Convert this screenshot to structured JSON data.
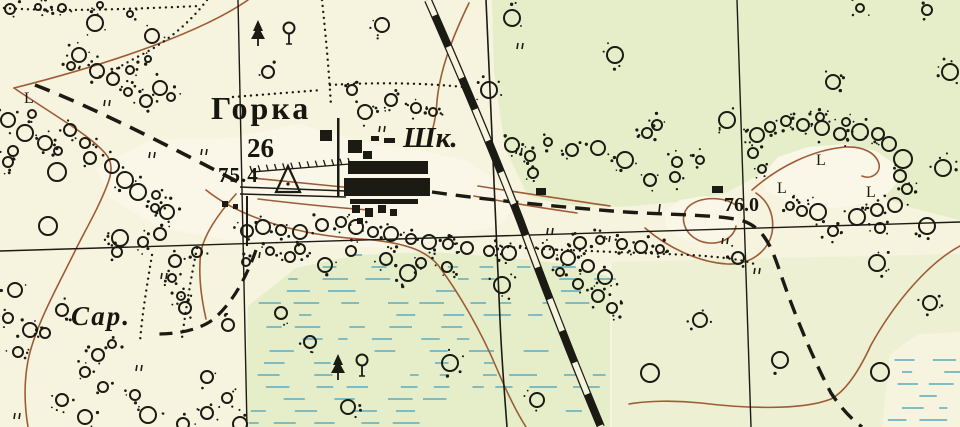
{
  "title": "Topographic map fragment — village Gorka",
  "labels": {
    "settlement": {
      "text": "Горка",
      "meaning": "village name"
    },
    "household_count": {
      "text": "26",
      "meaning": "number of households"
    },
    "elevation_point": {
      "text": "75.4",
      "meaning": "triangulation point elevation"
    },
    "school": {
      "text": "Шк.",
      "meaning": "school abbreviation"
    },
    "spot_height": {
      "text": "76.0",
      "meaning": "spot height"
    },
    "barn": {
      "text": "Сар.",
      "meaning": "barn abbreviation"
    },
    "meadow_letter": "L"
  },
  "colors": {
    "paper": "#f6f3de",
    "green_wash": "#e4edc6",
    "clearing_cream": "#faf7e8",
    "ink": "#1b1b13",
    "contour_brown": "#9e5c36",
    "marsh_blue": "#6fb4c2"
  },
  "map": {
    "width": 960,
    "height": 427,
    "grid_lines": [
      [
        238,
        0,
        247,
        427
      ],
      [
        737,
        0,
        751,
        427
      ],
      [
        0,
        251,
        960,
        222
      ]
    ],
    "railroad": {
      "d": "M428,0 C458,68 492,148 520,220 C545,288 575,365 601,427",
      "width": 8,
      "tie_dash": "34 34"
    },
    "boundary_line": {
      "d": "M486,0 C491,110 496,230 500,320 C502,365 505,400 507,427",
      "width": 1.6
    },
    "roads": [
      {
        "d": "M35,85 C100,110 180,152 242,184",
        "width": 3.6,
        "dash": "16 10"
      },
      {
        "d": "M432,192 C480,199 550,206 612,211 C660,215 712,214 740,220 C763,226 771,246 779,269 C793,311 813,359 831,393 C843,411 853,420 862,427",
        "width": 3.4,
        "dash": "15 9"
      },
      {
        "d": "M256,250 C246,278 234,300 216,317 C203,329 180,334 158,334",
        "width": 3.2,
        "dash": "13 8"
      },
      {
        "d": "M240,187 L346,191",
        "width": 1.5,
        "dash": ""
      },
      {
        "d": "M240,194 L346,197",
        "width": 1.5,
        "dash": ""
      }
    ],
    "contours": [
      "M248,0 C205,30 118,62 14,88",
      "M14,88 C55,116 88,134 105,153 C113,162 112,172 108,183 C99,207 87,227 76,249 C60,282 38,320 29,356 C23,383 25,409 28,427",
      "M236,194 C218,214 205,233 201,251 C198,273 201,297 206,319",
      "M469,3 C452,38 440,70 437,101 C436,119 433,131 428,141",
      "M206,190 C242,219 300,235 360,239 C406,242 426,251 438,265 C459,293 481,331 497,369 C508,395 517,413 526,427",
      "M252,178 C300,183 330,186 353,188",
      "M258,199 C300,204 340,208 369,210",
      "M478,186 C528,194 570,200 610,206",
      "M474,196 C515,204 549,209 577,213",
      "M737,206 C724,196 700,196 688,207 C679,218 684,234 700,241 C717,247 734,239 736,226",
      "M645,228 C667,247 697,262 727,264 C751,265 768,251 772,233 C775,215 768,201 756,193",
      "M752,190 C778,167 812,150 845,147 C863,146 876,153 879,164 C881,173 871,180 862,176",
      "M960,246 C930,262 896,300 871,345 C859,371 846,391 831,399 C801,411 741,408 701,403 C673,400 646,401 629,404"
    ],
    "green_washes": [
      {
        "poly": [
          [
            492,
            0
          ],
          [
            960,
            0
          ],
          [
            960,
            220
          ],
          [
            912,
            208
          ],
          [
            878,
            196
          ],
          [
            852,
            162
          ],
          [
            812,
            148
          ],
          [
            768,
            170
          ],
          [
            724,
            194
          ],
          [
            678,
            202
          ],
          [
            620,
            207
          ],
          [
            560,
            204
          ],
          [
            528,
            196
          ],
          [
            505,
            148
          ],
          [
            494,
            70
          ]
        ],
        "opacity": 0.9
      },
      {
        "poly": [
          [
            246,
            427
          ],
          [
            248,
            306
          ],
          [
            296,
            268
          ],
          [
            358,
            255
          ],
          [
            430,
            252
          ],
          [
            500,
            257
          ],
          [
            566,
            264
          ],
          [
            610,
            277
          ],
          [
            610,
            427
          ]
        ],
        "opacity": 0.9
      },
      {
        "poly": [
          [
            612,
            262
          ],
          [
            960,
            254
          ],
          [
            960,
            332
          ],
          [
            918,
            334
          ],
          [
            890,
            354
          ],
          [
            882,
            427
          ],
          [
            612,
            427
          ]
        ],
        "opacity": 0.45
      }
    ],
    "clearings": [
      [
        [
          760,
          178
        ],
        [
          778,
          157
        ],
        [
          808,
          147
        ],
        [
          845,
          144
        ],
        [
          876,
          151
        ],
        [
          894,
          164
        ],
        [
          898,
          182
        ],
        [
          884,
          197
        ],
        [
          854,
          206
        ],
        [
          820,
          209
        ],
        [
          789,
          201
        ],
        [
          767,
          192
        ]
      ],
      [
        [
          664,
          212
        ],
        [
          680,
          200
        ],
        [
          704,
          196
        ],
        [
          726,
          200
        ],
        [
          738,
          212
        ],
        [
          736,
          228
        ],
        [
          720,
          240
        ],
        [
          698,
          243
        ],
        [
          678,
          238
        ],
        [
          666,
          228
        ]
      ],
      [
        [
          96,
          168
        ],
        [
          150,
          140
        ],
        [
          230,
          138
        ],
        [
          300,
          124
        ],
        [
          360,
          142
        ],
        [
          430,
          152
        ],
        [
          470,
          162
        ],
        [
          500,
          185
        ],
        [
          520,
          200
        ],
        [
          500,
          225
        ],
        [
          450,
          238
        ],
        [
          380,
          248
        ],
        [
          300,
          243
        ],
        [
          230,
          240
        ],
        [
          160,
          228
        ],
        [
          110,
          198
        ]
      ]
    ],
    "marsh_regions": [
      {
        "poly": [
          [
            250,
            302
          ],
          [
            298,
            264
          ],
          [
            360,
            252
          ],
          [
            430,
            249
          ],
          [
            500,
            254
          ],
          [
            565,
            262
          ],
          [
            612,
            276
          ],
          [
            612,
            427
          ],
          [
            248,
            427
          ]
        ],
        "step": 12
      },
      {
        "poly": [
          [
            893,
            352
          ],
          [
            960,
            342
          ],
          [
            960,
            427
          ],
          [
            880,
            427
          ]
        ],
        "step": 12
      }
    ],
    "dotted_trails": [
      "M4,8 C60,12 130,9 200,6",
      "M207,0 C192,20 170,40 143,54 C130,61 120,66 112,72",
      "M233,97 L322,90",
      "M330,85 C380,82 430,83 472,88",
      "M322,0 C326,38 329,72 331,106",
      "M490,246 C550,250 620,252 690,255 C722,257 745,260 754,264",
      "M197,248 C191,278 186,308 182,338",
      "M152,255 C147,285 142,315 140,342"
    ],
    "buildings": [
      [
        337,
        118,
        2.5,
        78
      ],
      [
        348,
        161,
        80,
        13
      ],
      [
        344,
        178,
        86,
        18
      ],
      [
        350,
        199,
        68,
        5
      ],
      [
        320,
        130,
        12,
        11
      ],
      [
        348,
        140,
        14,
        13
      ],
      [
        363,
        151,
        9,
        8
      ],
      [
        371,
        136,
        8,
        5
      ],
      [
        384,
        138,
        11,
        5
      ],
      [
        352,
        205,
        8,
        8
      ],
      [
        365,
        208,
        8,
        9
      ],
      [
        378,
        205,
        8,
        8
      ],
      [
        390,
        209,
        7,
        7
      ],
      [
        357,
        218,
        6,
        6
      ],
      [
        222,
        201,
        6,
        6
      ],
      [
        233,
        204,
        5,
        5
      ],
      [
        536,
        188,
        10,
        7
      ],
      [
        712,
        186,
        11,
        7
      ],
      [
        246,
        196,
        2,
        50
      ]
    ],
    "fence": {
      "x1": 252,
      "y1": 172,
      "x2": 350,
      "y2": 164,
      "teeth": 12
    },
    "triangulation_point": {
      "points": "288,166 276,192 300,192",
      "dot": [
        288,
        184
      ]
    },
    "trees": [
      [
        "fir",
        258,
        38
      ],
      [
        "dec",
        289,
        38
      ],
      [
        "fir",
        338,
        372
      ],
      [
        "dec",
        362,
        370
      ]
    ],
    "meadow_symbols": [
      [
        24,
        90
      ],
      [
        816,
        152
      ],
      [
        777,
        180
      ],
      [
        866,
        184
      ]
    ],
    "grass_ticks": [
      [
        105,
        100
      ],
      [
        150,
        152
      ],
      [
        202,
        149
      ],
      [
        380,
        126
      ],
      [
        518,
        43
      ],
      [
        517,
        148
      ],
      [
        548,
        228
      ],
      [
        605,
        236
      ],
      [
        723,
        238
      ],
      [
        755,
        268
      ],
      [
        162,
        273
      ],
      [
        255,
        252
      ],
      [
        137,
        365
      ],
      [
        15,
        413
      ]
    ],
    "road_tick": [
      660,
      204,
      659,
      212
    ],
    "circles": [
      [
        10,
        9,
        5
      ],
      [
        38,
        7,
        3
      ],
      [
        62,
        8,
        4
      ],
      [
        100,
        5,
        3
      ],
      [
        152,
        36,
        7
      ],
      [
        95,
        23,
        8
      ],
      [
        130,
        14,
        3
      ],
      [
        79,
        55,
        7
      ],
      [
        97,
        71,
        7
      ],
      [
        113,
        79,
        6
      ],
      [
        71,
        66,
        4
      ],
      [
        130,
        70,
        4
      ],
      [
        148,
        59,
        3
      ],
      [
        160,
        88,
        7
      ],
      [
        146,
        101,
        6
      ],
      [
        128,
        92,
        4
      ],
      [
        171,
        97,
        4
      ],
      [
        8,
        120,
        7
      ],
      [
        25,
        133,
        8
      ],
      [
        45,
        143,
        7
      ],
      [
        70,
        130,
        6
      ],
      [
        85,
        143,
        5
      ],
      [
        13,
        151,
        5
      ],
      [
        58,
        151,
        4
      ],
      [
        32,
        114,
        4
      ],
      [
        57,
        172,
        9
      ],
      [
        8,
        162,
        5
      ],
      [
        90,
        158,
        6
      ],
      [
        112,
        166,
        7
      ],
      [
        125,
        180,
        8
      ],
      [
        138,
        192,
        8
      ],
      [
        156,
        195,
        4
      ],
      [
        167,
        212,
        7
      ],
      [
        155,
        208,
        4
      ],
      [
        120,
        238,
        8
      ],
      [
        143,
        242,
        5
      ],
      [
        160,
        234,
        6
      ],
      [
        48,
        226,
        9
      ],
      [
        117,
        252,
        5
      ],
      [
        15,
        290,
        7
      ],
      [
        30,
        330,
        7
      ],
      [
        8,
        318,
        5
      ],
      [
        45,
        333,
        5
      ],
      [
        62,
        310,
        6
      ],
      [
        18,
        352,
        5
      ],
      [
        98,
        355,
        6
      ],
      [
        85,
        372,
        5
      ],
      [
        112,
        344,
        4
      ],
      [
        62,
        400,
        6
      ],
      [
        85,
        417,
        7
      ],
      [
        103,
        387,
        5
      ],
      [
        148,
        415,
        8
      ],
      [
        183,
        424,
        6
      ],
      [
        135,
        395,
        5
      ],
      [
        175,
        261,
        6
      ],
      [
        197,
        252,
        5
      ],
      [
        207,
        377,
        6
      ],
      [
        227,
        398,
        5
      ],
      [
        207,
        413,
        6
      ],
      [
        240,
        424,
        7
      ],
      [
        185,
        308,
        6
      ],
      [
        228,
        325,
        6
      ],
      [
        172,
        278,
        4
      ],
      [
        181,
        296,
        4
      ],
      [
        247,
        231,
        6
      ],
      [
        263,
        227,
        7
      ],
      [
        281,
        230,
        5
      ],
      [
        300,
        232,
        7
      ],
      [
        322,
        225,
        6
      ],
      [
        341,
        222,
        5
      ],
      [
        356,
        227,
        7
      ],
      [
        373,
        232,
        5
      ],
      [
        391,
        234,
        7
      ],
      [
        411,
        239,
        5
      ],
      [
        429,
        242,
        7
      ],
      [
        448,
        244,
        5
      ],
      [
        467,
        248,
        6
      ],
      [
        489,
        251,
        5
      ],
      [
        509,
        253,
        7
      ],
      [
        351,
        251,
        5
      ],
      [
        386,
        259,
        6
      ],
      [
        421,
        263,
        5
      ],
      [
        447,
        267,
        5
      ],
      [
        300,
        249,
        5
      ],
      [
        270,
        251,
        4
      ],
      [
        246,
        262,
        4
      ],
      [
        365,
        112,
        7
      ],
      [
        391,
        100,
        6
      ],
      [
        352,
        90,
        5
      ],
      [
        416,
        108,
        5
      ],
      [
        489,
        90,
        8
      ],
      [
        512,
        18,
        8
      ],
      [
        382,
        25,
        7
      ],
      [
        268,
        72,
        6
      ],
      [
        433,
        112,
        4
      ],
      [
        512,
        145,
        7
      ],
      [
        530,
        156,
        5
      ],
      [
        548,
        142,
        4
      ],
      [
        572,
        150,
        6
      ],
      [
        598,
        148,
        7
      ],
      [
        625,
        160,
        8
      ],
      [
        647,
        133,
        5
      ],
      [
        657,
        125,
        5
      ],
      [
        677,
        162,
        5
      ],
      [
        700,
        160,
        4
      ],
      [
        727,
        120,
        8
      ],
      [
        615,
        55,
        8
      ],
      [
        533,
        173,
        5
      ],
      [
        548,
        252,
        6
      ],
      [
        568,
        258,
        7
      ],
      [
        588,
        266,
        6
      ],
      [
        605,
        277,
        7
      ],
      [
        578,
        284,
        5
      ],
      [
        598,
        296,
        6
      ],
      [
        612,
        308,
        5
      ],
      [
        560,
        272,
        4
      ],
      [
        580,
        243,
        6
      ],
      [
        600,
        240,
        4
      ],
      [
        622,
        244,
        5
      ],
      [
        641,
        247,
        6
      ],
      [
        660,
        249,
        4
      ],
      [
        325,
        265,
        7
      ],
      [
        408,
        273,
        8
      ],
      [
        502,
        285,
        8
      ],
      [
        450,
        363,
        8
      ],
      [
        537,
        400,
        7
      ],
      [
        348,
        407,
        7
      ],
      [
        290,
        257,
        5
      ],
      [
        281,
        313,
        6
      ],
      [
        310,
        342,
        6
      ],
      [
        757,
        135,
        7
      ],
      [
        753,
        153,
        5
      ],
      [
        762,
        169,
        4
      ],
      [
        770,
        127,
        5
      ],
      [
        786,
        121,
        5
      ],
      [
        803,
        125,
        6
      ],
      [
        822,
        128,
        7
      ],
      [
        840,
        134,
        6
      ],
      [
        860,
        132,
        8
      ],
      [
        878,
        134,
        6
      ],
      [
        889,
        144,
        7
      ],
      [
        903,
        159,
        9
      ],
      [
        900,
        176,
        6
      ],
      [
        907,
        189,
        5
      ],
      [
        943,
        168,
        8
      ],
      [
        895,
        205,
        7
      ],
      [
        877,
        210,
        6
      ],
      [
        857,
        217,
        8
      ],
      [
        818,
        212,
        8
      ],
      [
        790,
        206,
        4
      ],
      [
        802,
        211,
        5
      ],
      [
        927,
        226,
        8
      ],
      [
        880,
        228,
        5
      ],
      [
        833,
        231,
        5
      ],
      [
        650,
        180,
        6
      ],
      [
        675,
        177,
        5
      ],
      [
        846,
        122,
        4
      ],
      [
        820,
        117,
        4
      ],
      [
        833,
        82,
        7
      ],
      [
        950,
        72,
        8
      ],
      [
        927,
        10,
        5
      ],
      [
        860,
        8,
        4
      ],
      [
        877,
        263,
        8
      ],
      [
        738,
        258,
        6
      ],
      [
        880,
        372,
        9
      ],
      [
        780,
        360,
        8
      ],
      [
        650,
        373,
        9
      ],
      [
        930,
        303,
        7
      ],
      [
        700,
        320,
        7
      ]
    ]
  }
}
